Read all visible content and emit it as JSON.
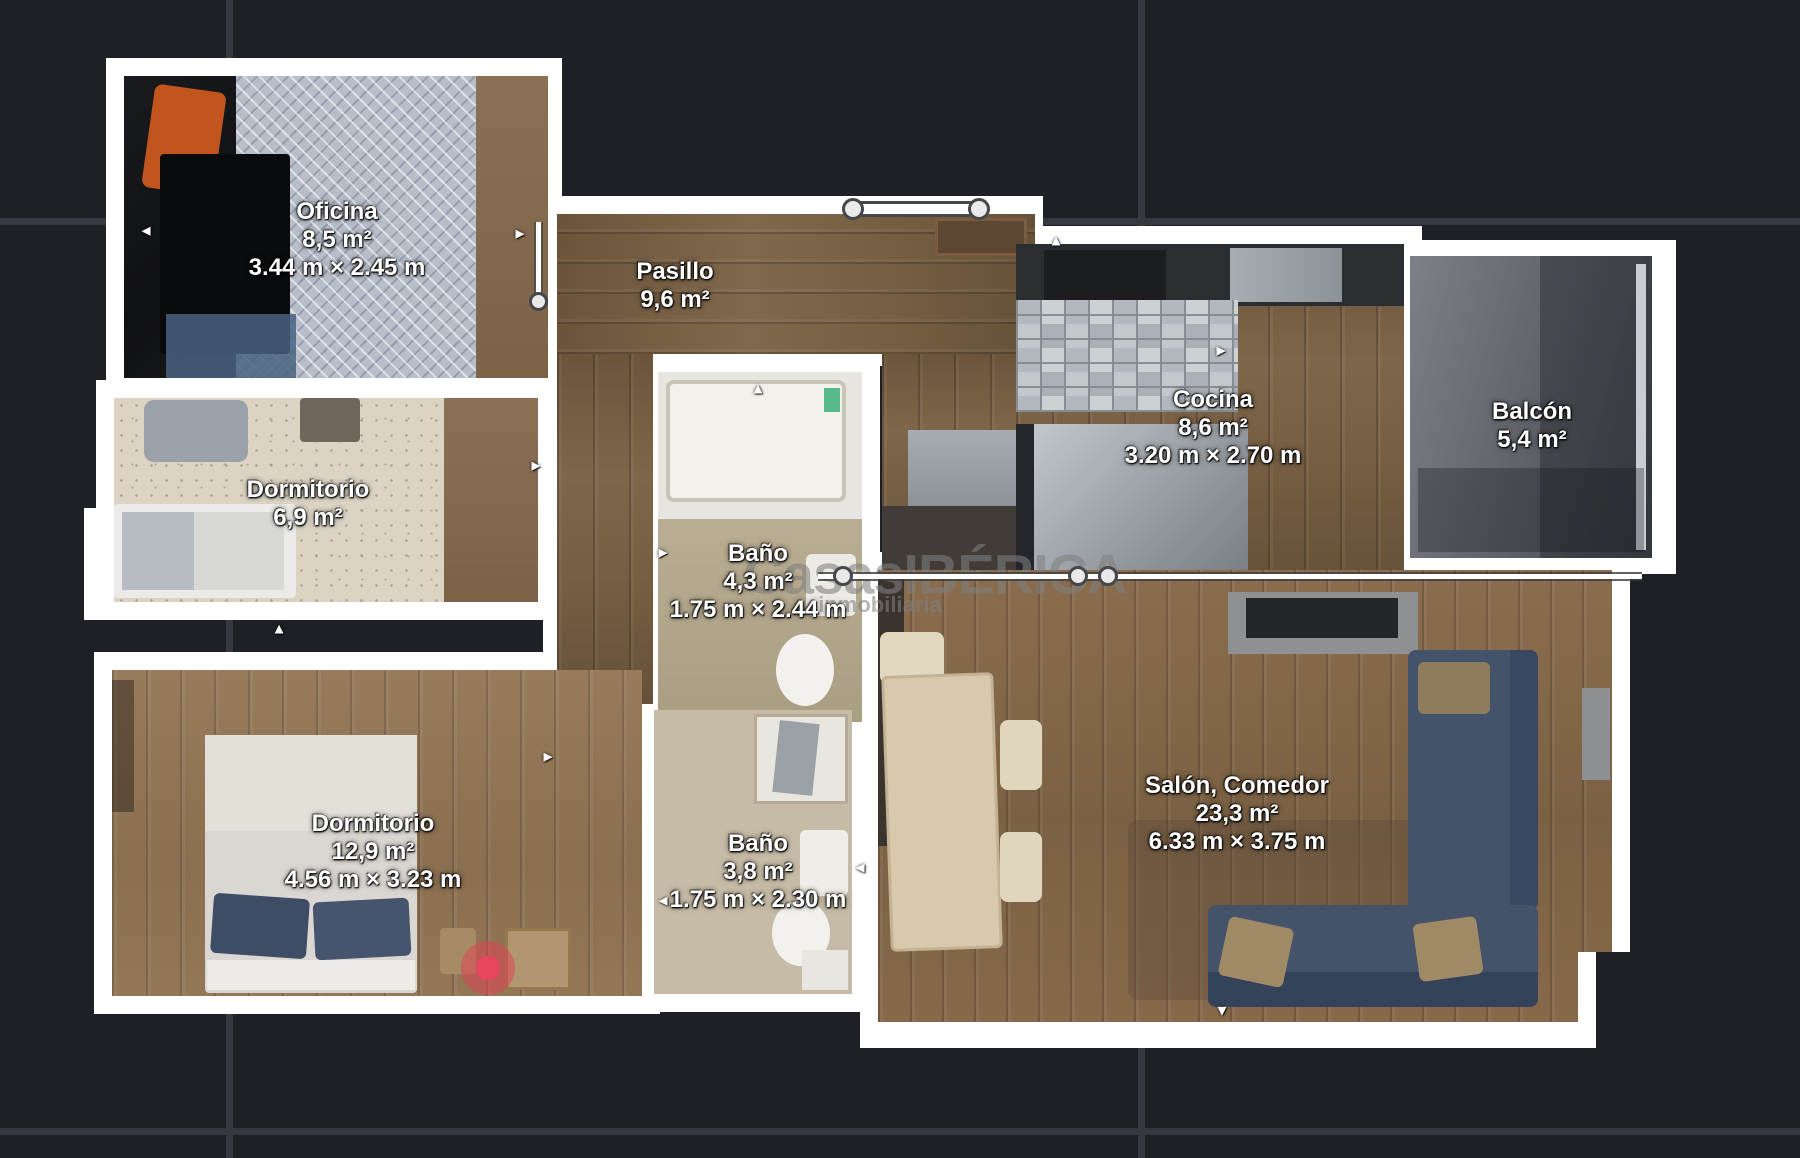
{
  "viewer": {
    "background": "#1e2025",
    "grid_color": "#35383e",
    "wall_color": "#ffffff",
    "marker_color": "#e7465e"
  },
  "watermark": {
    "logo": "CasasIBÉRICA",
    "tagline": "inmobiliaria"
  },
  "rooms": [
    {
      "id": "oficina",
      "name": "Oficina",
      "area": "8,5 m²",
      "dims": "3.44 m × 2.45 m"
    },
    {
      "id": "pasillo",
      "name": "Pasillo",
      "area": "9,6 m²",
      "dims": ""
    },
    {
      "id": "cocina",
      "name": "Cocina",
      "area": "8,6 m²",
      "dims": "3.20 m × 2.70 m"
    },
    {
      "id": "balcon",
      "name": "Balcón",
      "area": "5,4 m²",
      "dims": ""
    },
    {
      "id": "dormitorio1",
      "name": "Dormitorio",
      "area": "6,9 m²",
      "dims": ""
    },
    {
      "id": "bano1",
      "name": "Baño",
      "area": "4,3 m²",
      "dims": "1.75 m × 2.44 m"
    },
    {
      "id": "dormitorio2",
      "name": "Dormitorio",
      "area": "12,9 m²",
      "dims": "4.56 m × 3.23 m"
    },
    {
      "id": "bano2",
      "name": "Baño",
      "area": "3,8 m²",
      "dims": "1.75 m × 2.30 m"
    },
    {
      "id": "salon",
      "name": "Salón, Comedor",
      "area": "23,3 m²",
      "dims": "6.33 m × 3.75 m"
    }
  ],
  "icons": {
    "arrow_up": "▲",
    "arrow_down": "▼",
    "arrow_left": "◄",
    "arrow_right": "►"
  }
}
